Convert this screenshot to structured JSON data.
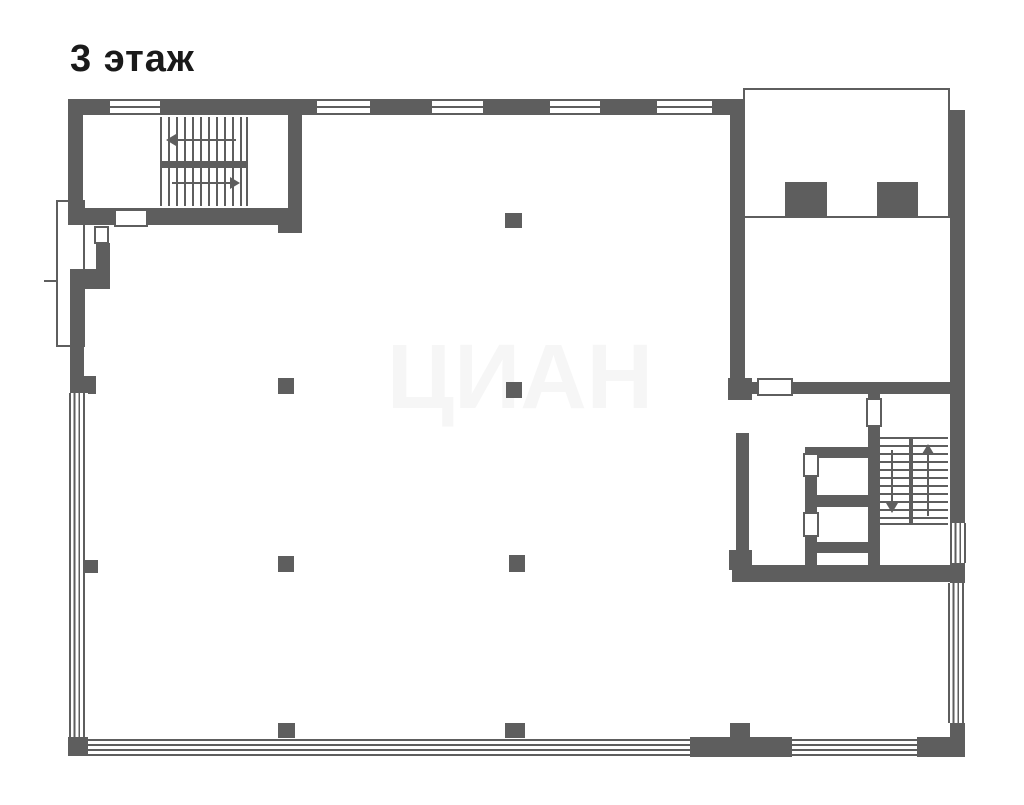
{
  "page": {
    "title": "3 этаж",
    "watermark": "ЦИАН"
  },
  "colors": {
    "background": "#ffffff",
    "wall": "#5e5e5e",
    "title_text": "#1a1a1a"
  },
  "plan": {
    "floor_label": "3 этаж",
    "type": "floor-plan",
    "staircases": [
      {
        "location": "top-left",
        "flights": 2,
        "arrow_directions": [
          "left",
          "right"
        ]
      },
      {
        "location": "right-middle",
        "flights": 2,
        "arrow_directions": [
          "down",
          "up"
        ]
      }
    ],
    "freestanding_columns": 9,
    "window_walls": [
      "top",
      "left",
      "bottom",
      "right"
    ],
    "small_rooms_right_side": 2,
    "top_right_annex": {
      "outline": "thin",
      "interior_blocks": 2
    }
  }
}
